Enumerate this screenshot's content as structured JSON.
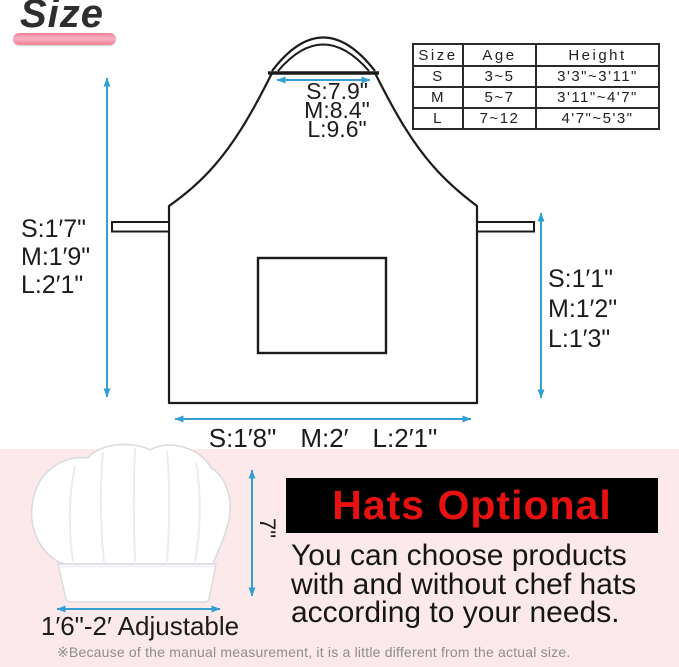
{
  "title": {
    "text": "Size"
  },
  "apron": {
    "neck_label": {
      "lines": [
        "S:7.9\"",
        "M:8.4\"",
        "L:9.6\""
      ]
    },
    "left_label": {
      "lines": [
        "S:1′7\"",
        "M:1′9\"",
        "L:2′1\""
      ]
    },
    "right_label": {
      "lines": [
        "S:1′1\"",
        "M:1′2\"",
        "L:1′3\""
      ]
    },
    "bottom_label": {
      "items": [
        "S:1′8\"",
        "M:2′",
        "L:2′1\""
      ]
    }
  },
  "size_table": {
    "headers": [
      "Size",
      "Age",
      "Height"
    ],
    "rows": [
      {
        "size": "S",
        "age": "3~5",
        "height": "3'3\"~3'11\""
      },
      {
        "size": "M",
        "age": "5~7",
        "height": "3'11\"~4'7\""
      },
      {
        "size": "L",
        "age": "7~12",
        "height": "4'7\"~5'3\""
      }
    ]
  },
  "hat_section": {
    "height_label": "7\"",
    "width_label": "1′6\"-2′ Adjustable",
    "banner": "Hats Optional",
    "description_lines": [
      "You can choose products",
      "with and without chef hats",
      "according to your needs."
    ],
    "footnote": "※Because of the manual measurement, it is a little different from the actual size."
  },
  "colors": {
    "arrow_blue": "#339fd2",
    "banner_bg": "#000000",
    "banner_text": "#e81111",
    "band_pink": "#fce9ec",
    "accent_pink": "#f29cab",
    "line_black": "#1b1b1b"
  }
}
